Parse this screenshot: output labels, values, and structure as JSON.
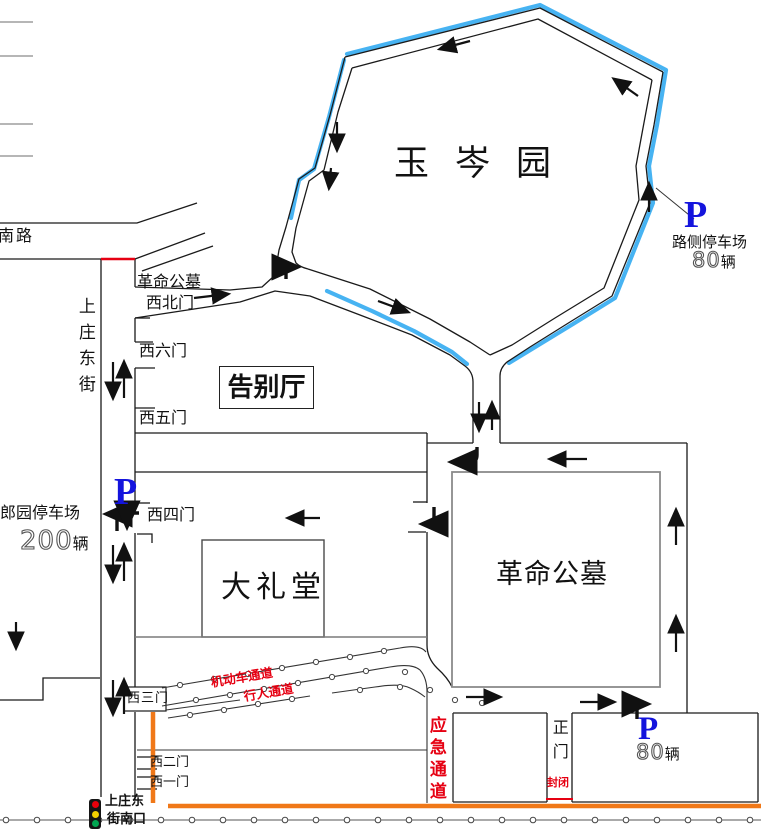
{
  "park_name": "玉岑园",
  "roadside_parking": {
    "symbol": "P",
    "name": "路侧停车场",
    "capacity": "80",
    "unit": "辆"
  },
  "langyuan_parking": {
    "symbol": "P",
    "name": "郎园停车场",
    "capacity": "200",
    "unit": "辆"
  },
  "south_parking": {
    "symbol": "P",
    "capacity": "80",
    "unit": "辆"
  },
  "streets": {
    "nanlu": "南路",
    "shangzhuang_east": "上庄东街"
  },
  "nw_gate": {
    "line1": "革命公墓",
    "line2": "西北门"
  },
  "gates": {
    "g6": "西六门",
    "g5": "西五门",
    "g4": "西四门",
    "g3": "西三门",
    "g2": "西二门",
    "g1": "西一门"
  },
  "halls": {
    "farewell": "告别厅",
    "great_hall": "大礼堂",
    "cemetery": "革命公墓"
  },
  "lanes": {
    "motor": "机动车通道",
    "pedestrian": "行人通道",
    "emergency": "应急通道"
  },
  "main_gate": {
    "name": "正门",
    "status": "封闭"
  },
  "intersection": {
    "line1": "上庄东",
    "line2": "街南口"
  },
  "colors": {
    "route_highlight": "#47B3F2",
    "parking_blue": "#1414DD",
    "alert_red": "#E60012",
    "closure_orange": "#F07818"
  }
}
